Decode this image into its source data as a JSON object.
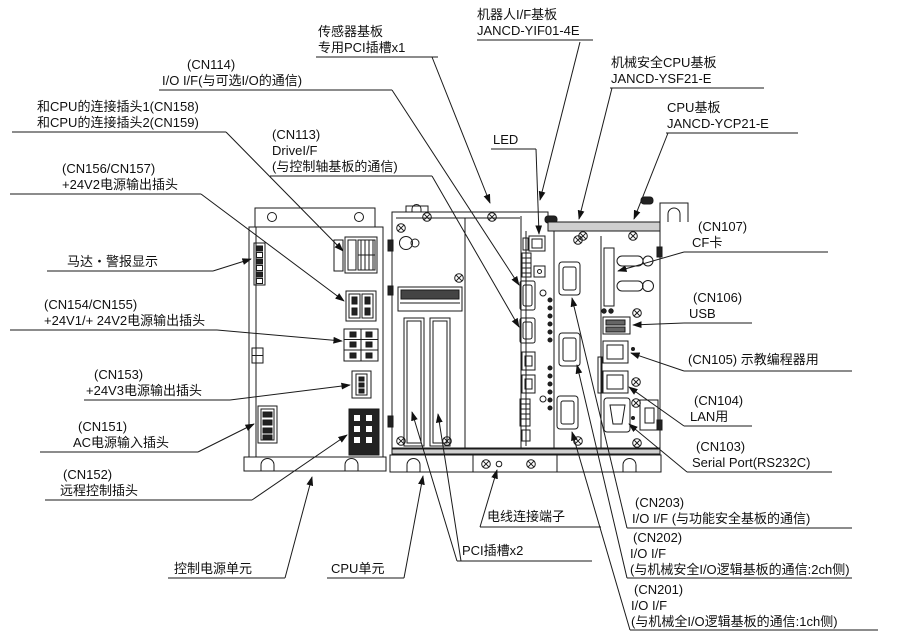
{
  "colors": {
    "line": "#1a1a1a",
    "dark_fill": "#222222",
    "gray_fill": "#cfcfcf",
    "background": "#ffffff"
  },
  "labels": {
    "sensor_board": {
      "line1": "传感器基板",
      "line2": "专用PCI插槽x1"
    },
    "robot_if": {
      "line1": "机器人I/F基板",
      "line2": "JANCD-YIF01-4E"
    },
    "safety_cpu": {
      "line1": "机械安全CPU基板",
      "line2": "JANCD-YSF21-E"
    },
    "cpu_board": {
      "line1": "CPU基板",
      "line2": "JANCD-YCP21-E"
    },
    "led": {
      "line1": "LED"
    },
    "cn114": {
      "line1": "(CN114)",
      "line2": "I/O I/F(与可选I/O的通信)"
    },
    "cn158_159": {
      "line1": "和CPU的连接插头1(CN158)",
      "line2": "和CPU的连接插头2(CN159)"
    },
    "cn113": {
      "line1": "(CN113)",
      "line2": "DriveI/F",
      "line3": "(与控制轴基板的通信)"
    },
    "cn156_157": {
      "line1": "(CN156/CN157)",
      "line2": "+24V2电源输出插头"
    },
    "motor_alarm": {
      "line1": "马达・警报显示"
    },
    "cn154_155": {
      "line1": "(CN154/CN155)",
      "line2": "+24V1/+ 24V2电源输出插头"
    },
    "cn153": {
      "line1": "(CN153)",
      "line2": "+24V3电源输出插头"
    },
    "cn151": {
      "line1": "(CN151)",
      "line2": "AC电源输入插头"
    },
    "cn152": {
      "line1": "(CN152)",
      "line2": "远程控制插头"
    },
    "control_power_unit": {
      "line1": "控制电源单元"
    },
    "cpu_unit": {
      "line1": "CPU单元"
    },
    "wire_terminal": {
      "line1": "电线连接端子"
    },
    "pci_slots": {
      "line1": "PCI插槽x2"
    },
    "cn107": {
      "line1": "(CN107)",
      "line2": "CF卡"
    },
    "cn106": {
      "line1": "(CN106)",
      "line2": "USB"
    },
    "cn105": {
      "line1": "(CN105) 示教编程器用"
    },
    "cn104": {
      "line1": "(CN104)",
      "line2": "LAN用"
    },
    "cn103": {
      "line1": "(CN103)",
      "line2": "Serial Port(RS232C)"
    },
    "cn203": {
      "line1": "(CN203)",
      "line2": "I/O I/F (与功能安全基板的通信)"
    },
    "cn202": {
      "line1": "(CN202)",
      "line2": "I/O I/F",
      "line3": "(与机械安全I/O逻辑基板的通信:2ch侧)"
    },
    "cn201": {
      "line1": "(CN201)",
      "line2": "I/O I/F",
      "line3": "(与机械全I/O逻辑基板的通信:1ch侧)"
    }
  }
}
